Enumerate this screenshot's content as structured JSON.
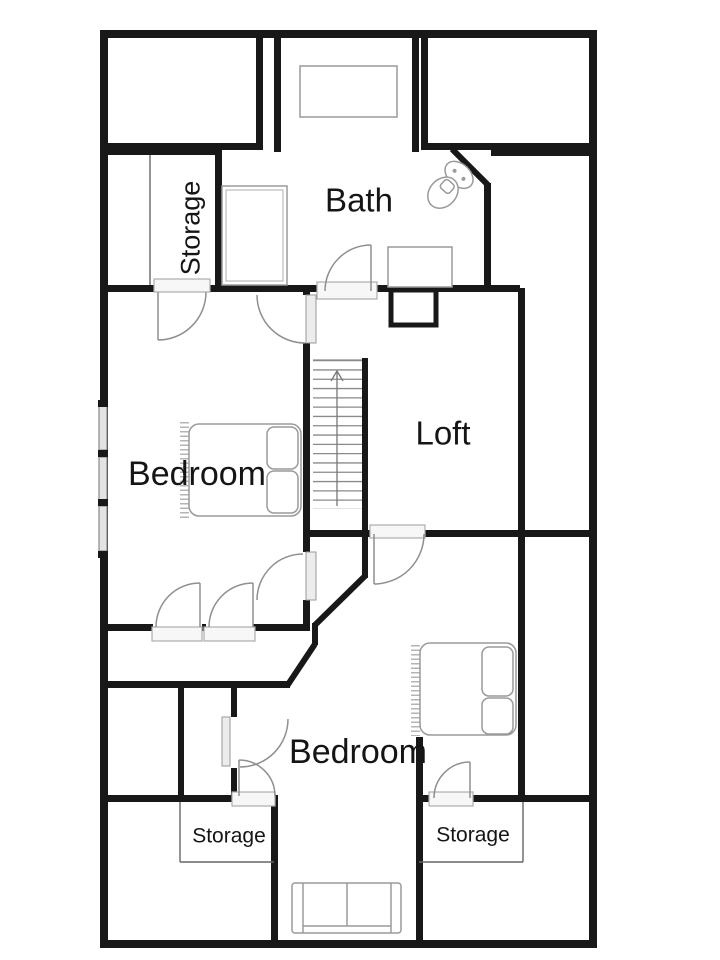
{
  "labels": {
    "bath": "Bath",
    "storage_top": "Storage",
    "bedroom_left": "Bedroom",
    "loft": "Loft",
    "bedroom_bottom": "Bedroom",
    "storage_bottom_left": "Storage",
    "storage_bottom_right": "Storage"
  },
  "colors": {
    "wall": "#181818",
    "fixture_line": "#9a9a9a",
    "door_arc": "#8f8f8f",
    "window_fill": "#e3e3e3"
  }
}
